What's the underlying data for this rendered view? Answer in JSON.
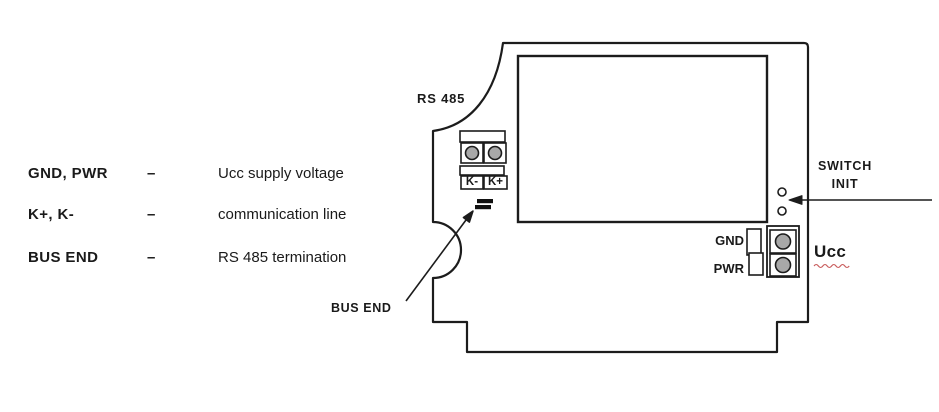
{
  "figure": {
    "type": "device-connection-diagram",
    "legend": {
      "rows": [
        {
          "term": "GND, PWR",
          "dash": "–",
          "description": "Ucc supply voltage"
        },
        {
          "term": "K+, K-",
          "dash": "–",
          "description": "communication line"
        },
        {
          "term": "BUS END",
          "dash": "–",
          "description": "RS 485 termination"
        }
      ]
    },
    "device": {
      "rs485_label": "RS 485",
      "terminal_k_minus": "K-",
      "terminal_k_plus": "K+",
      "bus_end_label": "BUS END",
      "switch_line1": "SWITCH",
      "switch_line2": "INIT",
      "gnd_label": "GND",
      "pwr_label": "PWR",
      "ucc_label": "Ucc"
    },
    "colors": {
      "line": "#1c1c1c",
      "screw_fill": "#a8a8a8",
      "spellcheck_underline": "#c85a5a"
    }
  }
}
